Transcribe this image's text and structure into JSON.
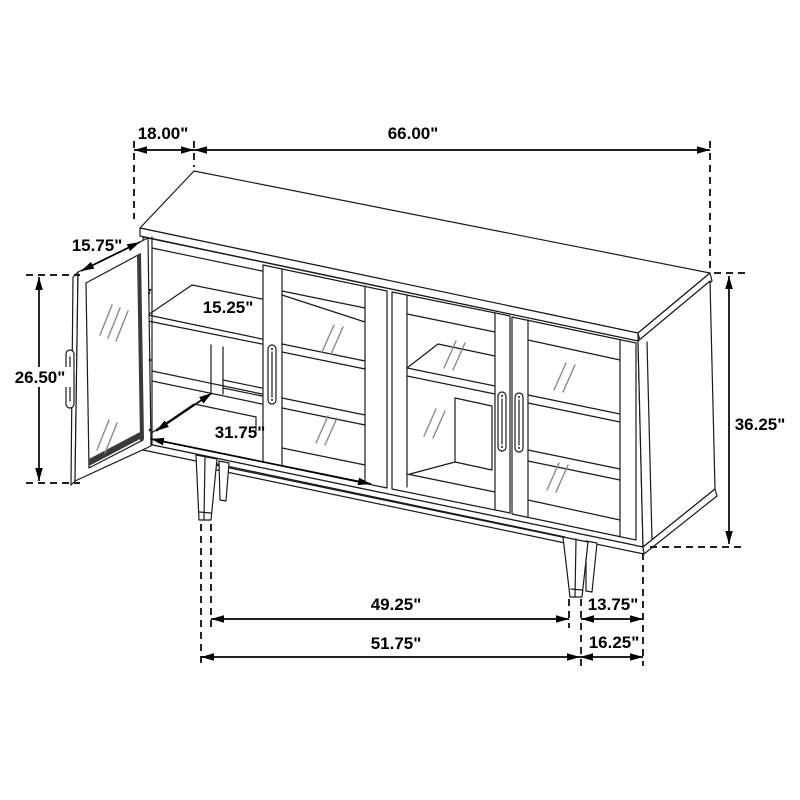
{
  "diagram": {
    "type": "furniture-dimension-drawing",
    "unit": "inches",
    "colors": {
      "background": "#ffffff",
      "line": "#1a1a1a",
      "dimension": "#000000",
      "glass_mark": "#8a8a8a",
      "dark_edge": "#3a3a3a"
    },
    "dimensions": {
      "top_depth": "18.00\"",
      "top_width": "66.00\"",
      "door_width": "15.75\"",
      "shelf_depth": "15.25\"",
      "door_height": "26.50\"",
      "interior_width": "31.75\"",
      "overall_height": "36.25\"",
      "front_leg_span": "49.25\"",
      "side_leg_span": "13.75\"",
      "front_base_span": "51.75\"",
      "side_base_span": "16.25\""
    }
  }
}
